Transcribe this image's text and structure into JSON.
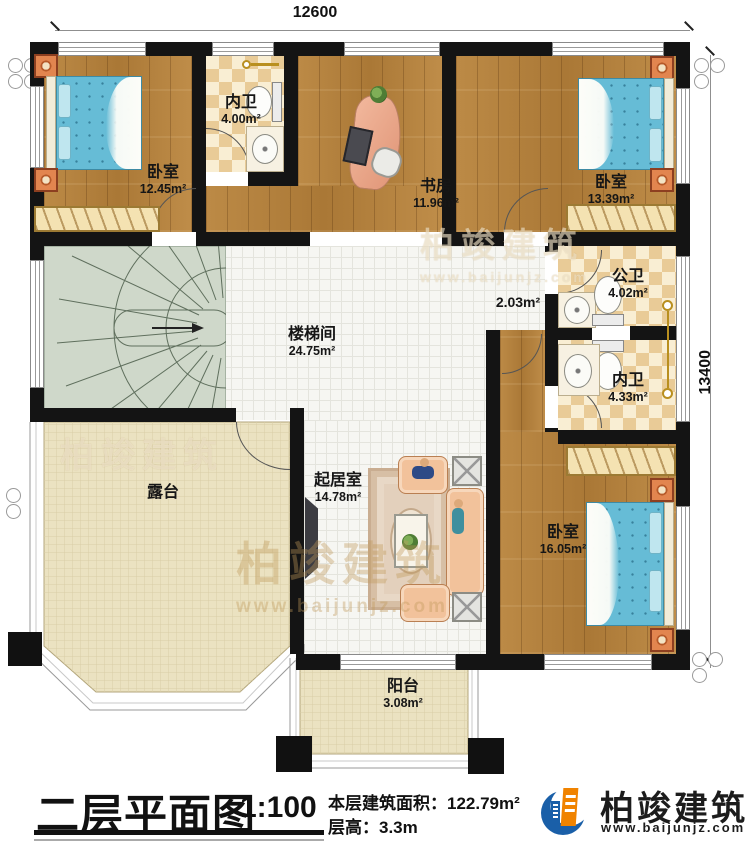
{
  "dimensions": {
    "top": "12600",
    "right": "13400"
  },
  "rooms": {
    "bedroom_tl": {
      "name": "卧室",
      "area": "12.45m²"
    },
    "bath_top": {
      "name": "内卫",
      "area": "4.00m²"
    },
    "study": {
      "name": "书房",
      "area": "11.96m²"
    },
    "bedroom_tr": {
      "name": "卧室",
      "area": "13.39m²"
    },
    "stairhall": {
      "name": "楼梯间",
      "area": "24.75m²"
    },
    "hall": {
      "area": "2.03m²"
    },
    "bath_public": {
      "name": "公卫",
      "area": "4.02m²"
    },
    "bath_inner": {
      "name": "内卫",
      "area": "4.33m²"
    },
    "terrace": {
      "name": "露台"
    },
    "living": {
      "name": "起居室",
      "area": "14.78m²"
    },
    "bedroom_br": {
      "name": "卧室",
      "area": "16.05m²"
    },
    "balcony": {
      "name": "阳台",
      "area": "3.08m²"
    }
  },
  "titleblock": {
    "title": "二层平面图",
    "scale": "1:100",
    "area_label": "本层建筑面积：",
    "area_value": "122.79m²",
    "height_label": "层高：",
    "height_value": "3.3m"
  },
  "branding": {
    "name": "柏竣建筑",
    "url": "www.baijunjz.com",
    "blue": "#1a5fa8",
    "orange": "#f08300"
  },
  "watermark": {
    "name": "柏竣建筑",
    "url": "www.baijunjz.com"
  }
}
